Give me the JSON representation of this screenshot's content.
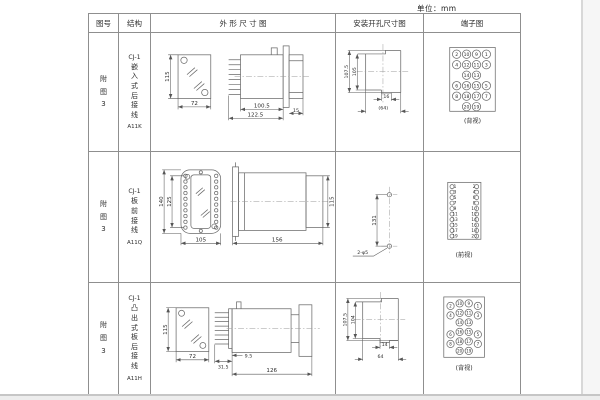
{
  "unit_label": "单位：mm",
  "header": {
    "figure": "图号",
    "structure": "结构",
    "outline": "外 形 尺 寸 图",
    "install": "安装开孔尺寸图",
    "terminal": "端子图"
  },
  "rows": [
    {
      "figure": "附图3",
      "model": "CJ-1",
      "structure": "嵌入式后接线",
      "code": "A11K",
      "outline": {
        "front_h": "115",
        "front_w": "72",
        "body_len": "100.5",
        "total_len": "122.5",
        "bezel": "15"
      },
      "install": {
        "outer_h": "107.5",
        "inner_h": "105",
        "slot_w": "16",
        "span_w": "(64)"
      },
      "terminal": {
        "caption": "(背视)"
      }
    },
    {
      "figure": "附图3",
      "model": "CJ-1",
      "structure": "板前接线",
      "code": "A11Q",
      "outline": {
        "outer_h": "140",
        "inner_h": "125",
        "front_w": "105",
        "total_len": "156",
        "rear_h": "115"
      },
      "install": {
        "hole_pitch": "131",
        "hole_note": "2-φ5"
      },
      "terminal": {
        "caption": "(前视)"
      }
    },
    {
      "figure": "附图3",
      "model": "CJ-1",
      "structure": "凸出式板后接线",
      "code": "A11H",
      "outline": {
        "front_h": "115",
        "front_w": "72",
        "pin_depth": "31.5",
        "offset": "9.5",
        "total_len": "126"
      },
      "install": {
        "outer_h": "107.5",
        "inner_h": "104",
        "slot_w": "14",
        "span_w": "64"
      },
      "terminal": {
        "caption": "(背视)"
      }
    }
  ],
  "terminal_layouts": {
    "rear_cells": [
      {
        "c": 0,
        "r": 0,
        "n": "2"
      },
      {
        "c": 1,
        "r": 0,
        "n": "10"
      },
      {
        "c": 2,
        "r": 0,
        "n": "9"
      },
      {
        "c": 3,
        "r": 0,
        "n": "1"
      },
      {
        "c": 0,
        "r": 1,
        "n": "4"
      },
      {
        "c": 1,
        "r": 1,
        "n": "12"
      },
      {
        "c": 2,
        "r": 1,
        "n": "11"
      },
      {
        "c": 3,
        "r": 1,
        "n": "3"
      },
      {
        "c": 1,
        "r": 2,
        "n": "14"
      },
      {
        "c": 2,
        "r": 2,
        "n": "13"
      },
      {
        "c": 0,
        "r": 3,
        "n": "6"
      },
      {
        "c": 1,
        "r": 3,
        "n": "16"
      },
      {
        "c": 2,
        "r": 3,
        "n": "15"
      },
      {
        "c": 3,
        "r": 3,
        "n": "5"
      },
      {
        "c": 0,
        "r": 4,
        "n": "8"
      },
      {
        "c": 1,
        "r": 4,
        "n": "18"
      },
      {
        "c": 2,
        "r": 4,
        "n": "17"
      },
      {
        "c": 3,
        "r": 4,
        "n": "7"
      },
      {
        "c": 1,
        "r": 5,
        "n": "20"
      },
      {
        "c": 2,
        "r": 5,
        "n": "19"
      }
    ],
    "front_pairs": [
      [
        "1",
        "2"
      ],
      [
        "3",
        "4"
      ],
      [
        "5",
        "6"
      ],
      [
        "7",
        "8"
      ],
      [
        "9",
        "10"
      ],
      [
        "11",
        "12"
      ],
      [
        "13",
        "14"
      ],
      [
        "15",
        "16"
      ],
      [
        "17",
        "18"
      ],
      [
        "19",
        "20"
      ]
    ]
  }
}
